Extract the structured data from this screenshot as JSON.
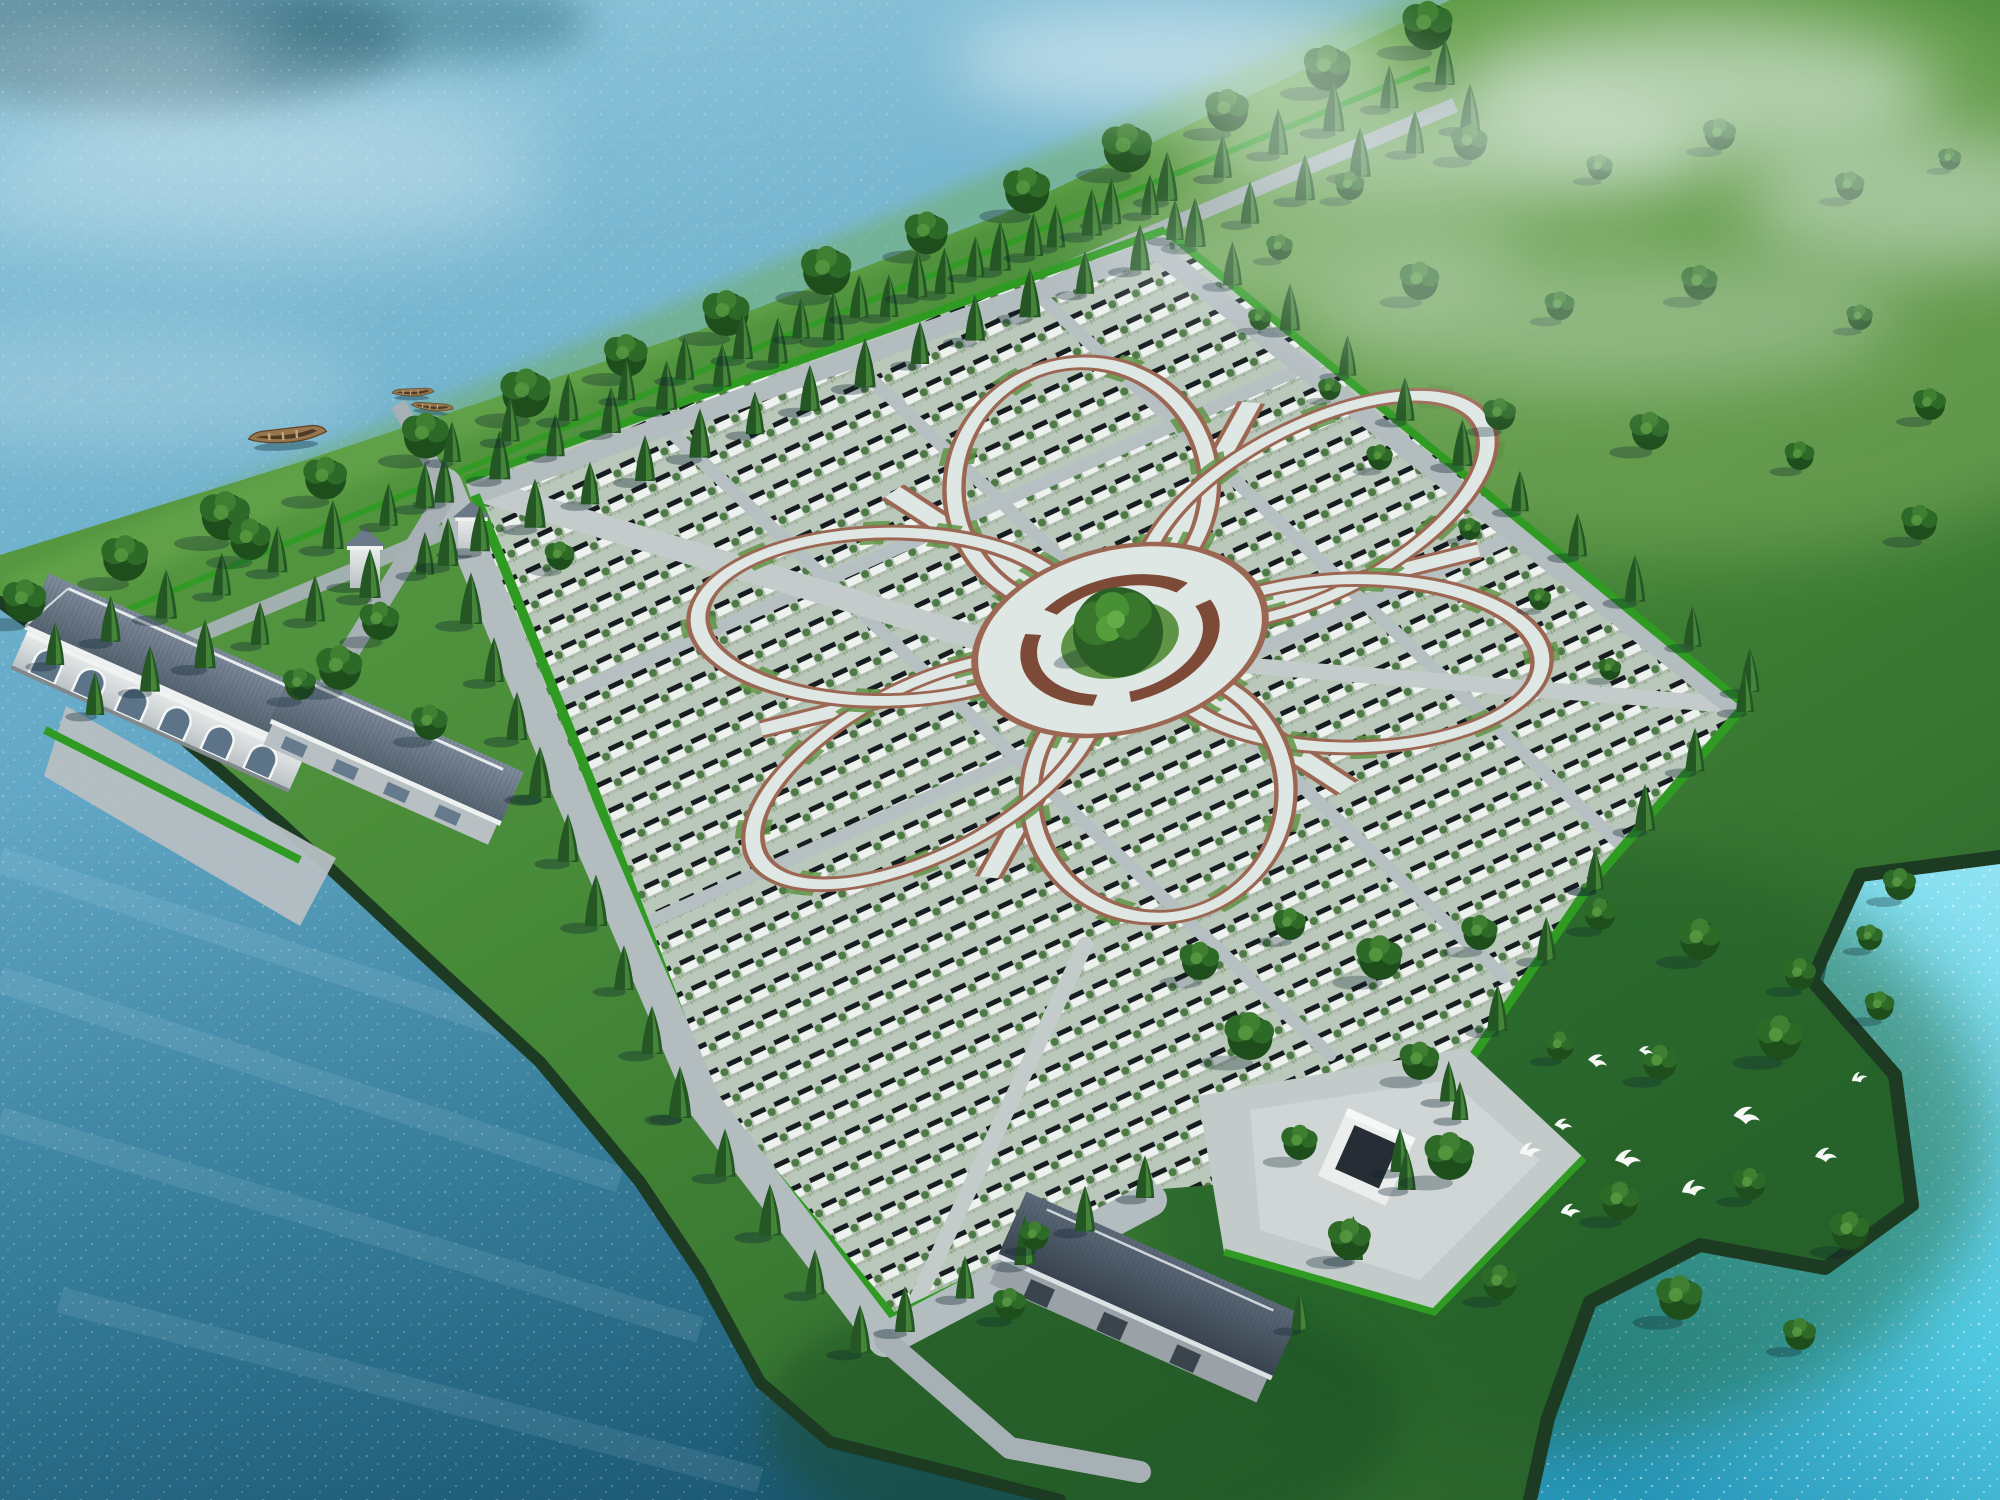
{
  "scene": {
    "description": "Aerial bird's-eye 3D architectural rendering of a lakeside memorial park: thousands of grave plots arranged in diagonal rows inside a diamond-shaped site, organised around a six-petal flower of paved paths with a central circular plaza and large tree",
    "water": "lake surrounding the peninsula on the top-left, bottom-left and a bright inlet on the right",
    "landmarks": "two service buildings with arched windows at the west entrance, two gate towers, one building with courtyard at the south corner, tree-lined avenue along the north shore, wooden boats, flock of white birds over the east meadow, mist over the north-east parkland"
  },
  "features": {
    "flower_petals": 6,
    "flower_spokes": 6,
    "gate_towers": 2,
    "buildings": 3,
    "boats": 3,
    "bird_flock": 10,
    "tree_rows": 12
  },
  "colors": {
    "water_top": "#8cc4da",
    "water_mid": "#62a8c6",
    "water_deep": "#347b98",
    "water_deepest": "#1a5671",
    "inlet_bright": "#8fe2f2",
    "inlet_mid": "#52c9e3",
    "inlet_dark": "#2795b8",
    "sparkle": "#ffffff",
    "mist": "#eef6f8",
    "reflection_dark": "#2b5a6b",
    "shore_border": "#1d3a22",
    "land_light": "#63a348",
    "land_mid": "#478a38",
    "land_dark": "#2a642c",
    "bank_sun": "#6fae52",
    "park_light": "#86b264",
    "meadow_dark": "#1c5a28",
    "field_ground": "#bac7bb",
    "plot_white": "#eef2ee",
    "plot_dark": "#171c20",
    "plot_bush": "#4e7a45",
    "plot_sprig": "#7fa36e",
    "path_pave": "#dfe7e5",
    "path_edge": "#9b6753",
    "ring_brown": "#7e4a38",
    "plaza_green": "#5f9447",
    "road": "#a7b1b5",
    "road_light": "#b3bcbf",
    "hedge": "#2f9b22",
    "cypress_dark": "#245723",
    "cypress_light": "#4e9140",
    "tree_dark": "#1f4e1d",
    "tree_mid": "#2d6a28",
    "tree_light": "#3f7f31",
    "center_tree_dark": "#2b5e25",
    "center_tree_mid": "#38772c",
    "center_tree_light": "#479033",
    "roof_light": "#7e8c9c",
    "roof_dark": "#55626f",
    "roof3_light": "#5c6a79",
    "roof3_dark": "#39434f",
    "wall_white": "#e9ecec",
    "wall_shade": "#b9c0c3",
    "window": "#5d7488",
    "boat_hull": "#96764e",
    "bird": "#f5f8f5"
  }
}
